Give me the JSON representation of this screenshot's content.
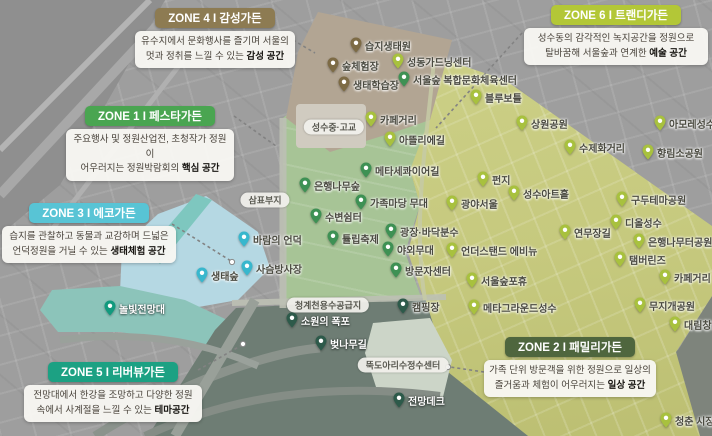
{
  "zones": [
    {
      "num": 1,
      "title": "ZONE 1 I 페스타가든",
      "line1": "주요행사 및 정원산업전, 초청작가 정원이",
      "line2": "어우러지는 정원박람회의 ",
      "bold": "핵심 공간",
      "color": "#4aa551"
    },
    {
      "num": 2,
      "title": "ZONE 2 I 패밀리가든",
      "line1": "가족 단위 방문객을 위한 정원으로 일상의",
      "line2": "즐거움과 체험이 어우러지는 ",
      "bold": "일상 공간",
      "color": "#4f663e"
    },
    {
      "num": 3,
      "title": "ZONE 3 I 에코가든",
      "line1": "습지를 관찰하고 동물과 교감하며 드넓은",
      "line2": "언덕정원을 거닐 수 있는 ",
      "bold": "생태체험 공간",
      "color": "#58c4d5"
    },
    {
      "num": 4,
      "title": "ZONE 4 I 감성가든",
      "line1": "유수지에서 문화행사를 즐기며 서울의",
      "line2": "멋과 정취를 느낄 수 있는 ",
      "bold": "감성 공간",
      "color": "#8d7b52"
    },
    {
      "num": 5,
      "title": "ZONE 5 I 리버뷰가든",
      "line1": "전망대에서 한강을 조망하고 다양한 정원",
      "line2": "속에서 사계절을 느낄 수 있는 ",
      "bold": "테마공간",
      "color": "#1ca183"
    },
    {
      "num": 6,
      "title": "ZONE 6 I 트랜디가든",
      "line1": "성수동의 감각적인 녹지공간을 정원으로",
      "line2": "탈바꿈해 서울숲과 연계한 ",
      "bold": "예술 공간",
      "color": "#b3c737"
    }
  ],
  "map": {
    "pin_colors": {
      "brown": "#7d6b45",
      "green": "#3e9154",
      "lime": "#a8c13e",
      "cyan": "#38b7cd",
      "teal": "#129a7e",
      "darkgreen": "#2d5a4a"
    },
    "region_colors": {
      "taupe": "#b2a593",
      "forest_green": "#a7c496",
      "yellow_green": "#c6c97e",
      "light_blue": "#b5d8e3",
      "teal": "#8cc4ba",
      "dark_slate": "#6e7d74",
      "city_gray": "#9e9e9e"
    },
    "pins": [
      {
        "label": "습지생태원",
        "x": 356,
        "y": 53,
        "type": "brown"
      },
      {
        "label": "숲체험장",
        "x": 333,
        "y": 73,
        "type": "brown"
      },
      {
        "label": "생태학습장",
        "x": 344,
        "y": 92,
        "type": "brown"
      },
      {
        "label": "서울숲 복합문화체육센터",
        "x": 404,
        "y": 87,
        "type": "green"
      },
      {
        "label": "메타세콰이어길",
        "x": 366,
        "y": 178,
        "type": "green"
      },
      {
        "label": "은행나무숲",
        "x": 305,
        "y": 193,
        "type": "green"
      },
      {
        "label": "가족마당 무대",
        "x": 361,
        "y": 210,
        "type": "green"
      },
      {
        "label": "수변쉼터",
        "x": 316,
        "y": 224,
        "type": "green"
      },
      {
        "label": "튤립축제",
        "x": 333,
        "y": 246,
        "type": "green"
      },
      {
        "label": "광장·바닥분수",
        "x": 391,
        "y": 239,
        "type": "green"
      },
      {
        "label": "야외무대",
        "x": 388,
        "y": 257,
        "type": "green"
      },
      {
        "label": "방문자센터",
        "x": 396,
        "y": 278,
        "type": "green"
      },
      {
        "label": "성동가드닝센터",
        "x": 398,
        "y": 69,
        "type": "lime"
      },
      {
        "label": "블루보틀",
        "x": 476,
        "y": 105,
        "type": "lime"
      },
      {
        "label": "카페거리",
        "x": 371,
        "y": 127,
        "type": "lime"
      },
      {
        "label": "아뜰리에길",
        "x": 390,
        "y": 147,
        "type": "lime"
      },
      {
        "label": "상원공원",
        "x": 522,
        "y": 131,
        "type": "lime"
      },
      {
        "label": "수제화거리",
        "x": 570,
        "y": 155,
        "type": "lime"
      },
      {
        "label": "아모레성수",
        "x": 660,
        "y": 131,
        "type": "lime"
      },
      {
        "label": "향림소공원",
        "x": 648,
        "y": 160,
        "type": "lime"
      },
      {
        "label": "펀지",
        "x": 483,
        "y": 187,
        "type": "lime"
      },
      {
        "label": "성수아트홀",
        "x": 514,
        "y": 201,
        "type": "lime"
      },
      {
        "label": "광야서울",
        "x": 452,
        "y": 211,
        "type": "lime"
      },
      {
        "label": "구두테마공원",
        "x": 622,
        "y": 207,
        "type": "lime"
      },
      {
        "label": "연무장길",
        "x": 565,
        "y": 240,
        "type": "lime"
      },
      {
        "label": "디올성수",
        "x": 616,
        "y": 230,
        "type": "lime"
      },
      {
        "label": "은행나무터공원",
        "x": 639,
        "y": 249,
        "type": "lime"
      },
      {
        "label": "탬버린즈",
        "x": 620,
        "y": 267,
        "type": "lime"
      },
      {
        "label": "언더스탠드 에비뉴",
        "x": 452,
        "y": 258,
        "type": "lime"
      },
      {
        "label": "서울숲포휴",
        "x": 472,
        "y": 288,
        "type": "lime"
      },
      {
        "label": "메타그라운드성수",
        "x": 474,
        "y": 315,
        "type": "lime"
      },
      {
        "label": "카페거리",
        "x": 665,
        "y": 285,
        "type": "lime"
      },
      {
        "label": "무지개공원",
        "x": 640,
        "y": 313,
        "type": "lime"
      },
      {
        "label": "대림창고",
        "x": 675,
        "y": 332,
        "type": "lime"
      },
      {
        "label": "청춘 시장",
        "x": 666,
        "y": 428,
        "type": "lime"
      },
      {
        "label": "바람의 언덕",
        "x": 244,
        "y": 247,
        "type": "cyan"
      },
      {
        "label": "사슴방사장",
        "x": 247,
        "y": 276,
        "type": "cyan"
      },
      {
        "label": "생태숲",
        "x": 202,
        "y": 283,
        "type": "cyan"
      },
      {
        "label": "캠핑장",
        "x": 403,
        "y": 314,
        "type": "darkgreen"
      },
      {
        "label": "소원의 폭포",
        "x": 292,
        "y": 328,
        "type": "darkgreen",
        "light": true
      },
      {
        "label": "벚나무길",
        "x": 321,
        "y": 351,
        "type": "darkgreen",
        "light": true
      },
      {
        "label": "전망데크",
        "x": 399,
        "y": 408,
        "type": "darkgreen",
        "light": true
      },
      {
        "label": "놀빛전망대",
        "x": 110,
        "y": 316,
        "type": "teal",
        "light": true
      }
    ],
    "chips": [
      {
        "label": "삼표부지",
        "x": 265,
        "y": 200
      },
      {
        "label": "성수중·고교",
        "x": 334,
        "y": 127
      },
      {
        "label": "청계천용수공급지",
        "x": 328,
        "y": 305
      },
      {
        "label": "뚝도아리수정수센터",
        "x": 403,
        "y": 365
      }
    ]
  }
}
